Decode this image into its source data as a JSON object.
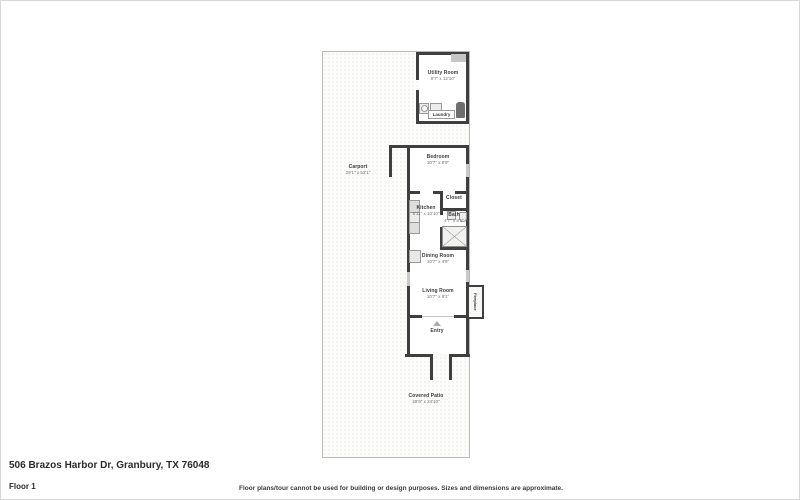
{
  "page": {
    "address": "506 Brazos Harbor Dr, Granbury, TX 76048",
    "floor_label": "Floor 1",
    "disclaimer": "Floor plans/tour cannot be used for building or design purposes. Sizes and dimensions are approximate."
  },
  "rooms": {
    "utility": {
      "name": "Utility Room",
      "dims": "8'7\" x 12'10\""
    },
    "laundry": {
      "name": "Laundry"
    },
    "carport": {
      "name": "Carport",
      "dims": "29'1\" x 53'1\""
    },
    "bedroom": {
      "name": "Bedroom",
      "dims": "10'7\" x 8'9\""
    },
    "closet": {
      "name": "Closet"
    },
    "kitchen": {
      "name": "Kitchen",
      "dims": "5'11\" x 10'10\""
    },
    "bath": {
      "name": "Bath",
      "dims": "4'7\" x 8'1\""
    },
    "dining": {
      "name": "Dining Room",
      "dims": "10'7\" x 4'9\""
    },
    "living": {
      "name": "Living Room",
      "dims": "10'7\" x 8'1\""
    },
    "entry": {
      "name": "Entry"
    },
    "fireplace": {
      "name": "Fireplace"
    },
    "patio": {
      "name": "Covered Patio",
      "dims": "28'9\" x 24'10\""
    }
  },
  "colors": {
    "wall": "#3f3f3f",
    "window": "#c9c9c9",
    "lot_border": "#b9b9b9"
  }
}
